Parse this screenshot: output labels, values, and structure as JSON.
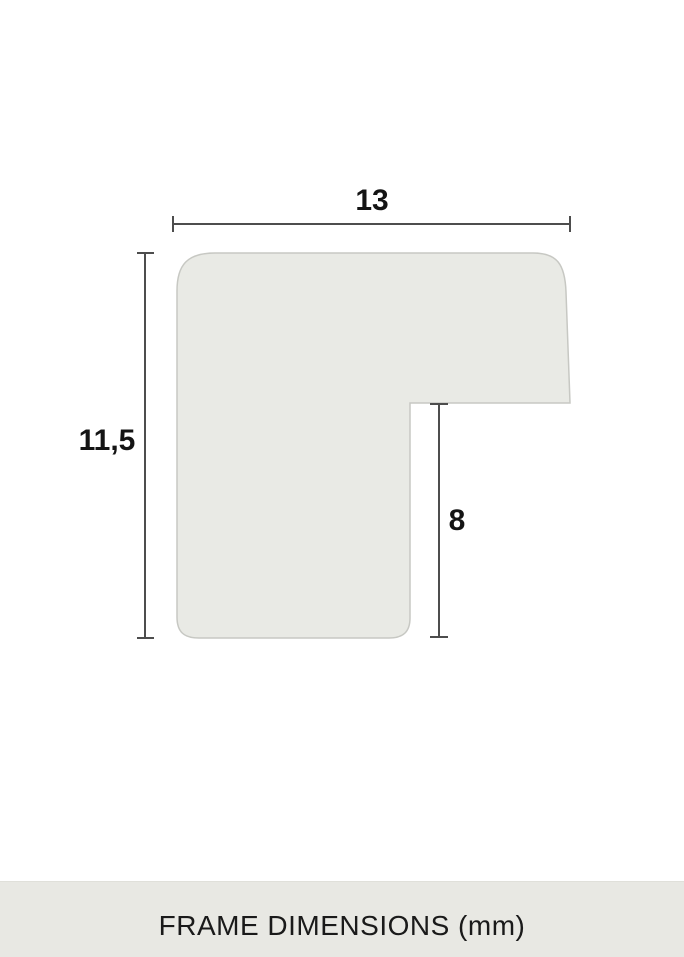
{
  "diagram": {
    "dimension_labels": {
      "top_width": "13",
      "left_height": "11,5",
      "rabbet_depth": "8"
    },
    "colors": {
      "shape_fill": "#e9eae5",
      "shape_border": "#c7c8c3",
      "dimension_line": "#4d4d4d",
      "label_text": "#141414"
    }
  },
  "footer": {
    "label": "FRAME DIMENSIONS (mm)",
    "background": "#e8e8e3",
    "text_color": "#1a1a1a"
  }
}
